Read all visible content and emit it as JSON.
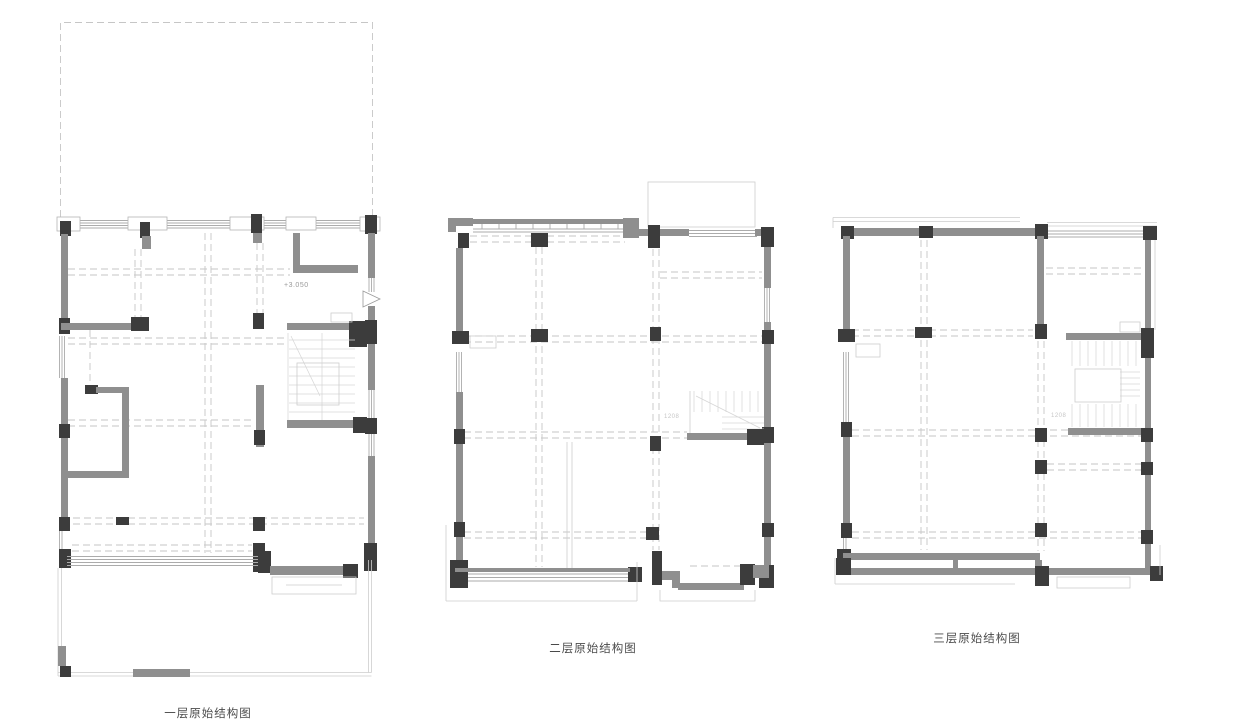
{
  "plans": [
    {
      "caption": "一层原始结构图"
    },
    {
      "caption": "二层原始结构图"
    },
    {
      "caption": "三层原始结构图"
    }
  ],
  "annotations": {
    "floor1_level": "+3.050",
    "floor2_stair_dim": "1208",
    "floor3_stair_dim": "1208"
  },
  "colors": {
    "background": "#ffffff",
    "wall": "#8f8f8f",
    "column": "#3c3c3c",
    "window_line": "#ababab",
    "dashed_line": "#c6c6c6",
    "faint_line": "#cdcdcd",
    "caption_text": "#4a4a4a"
  }
}
